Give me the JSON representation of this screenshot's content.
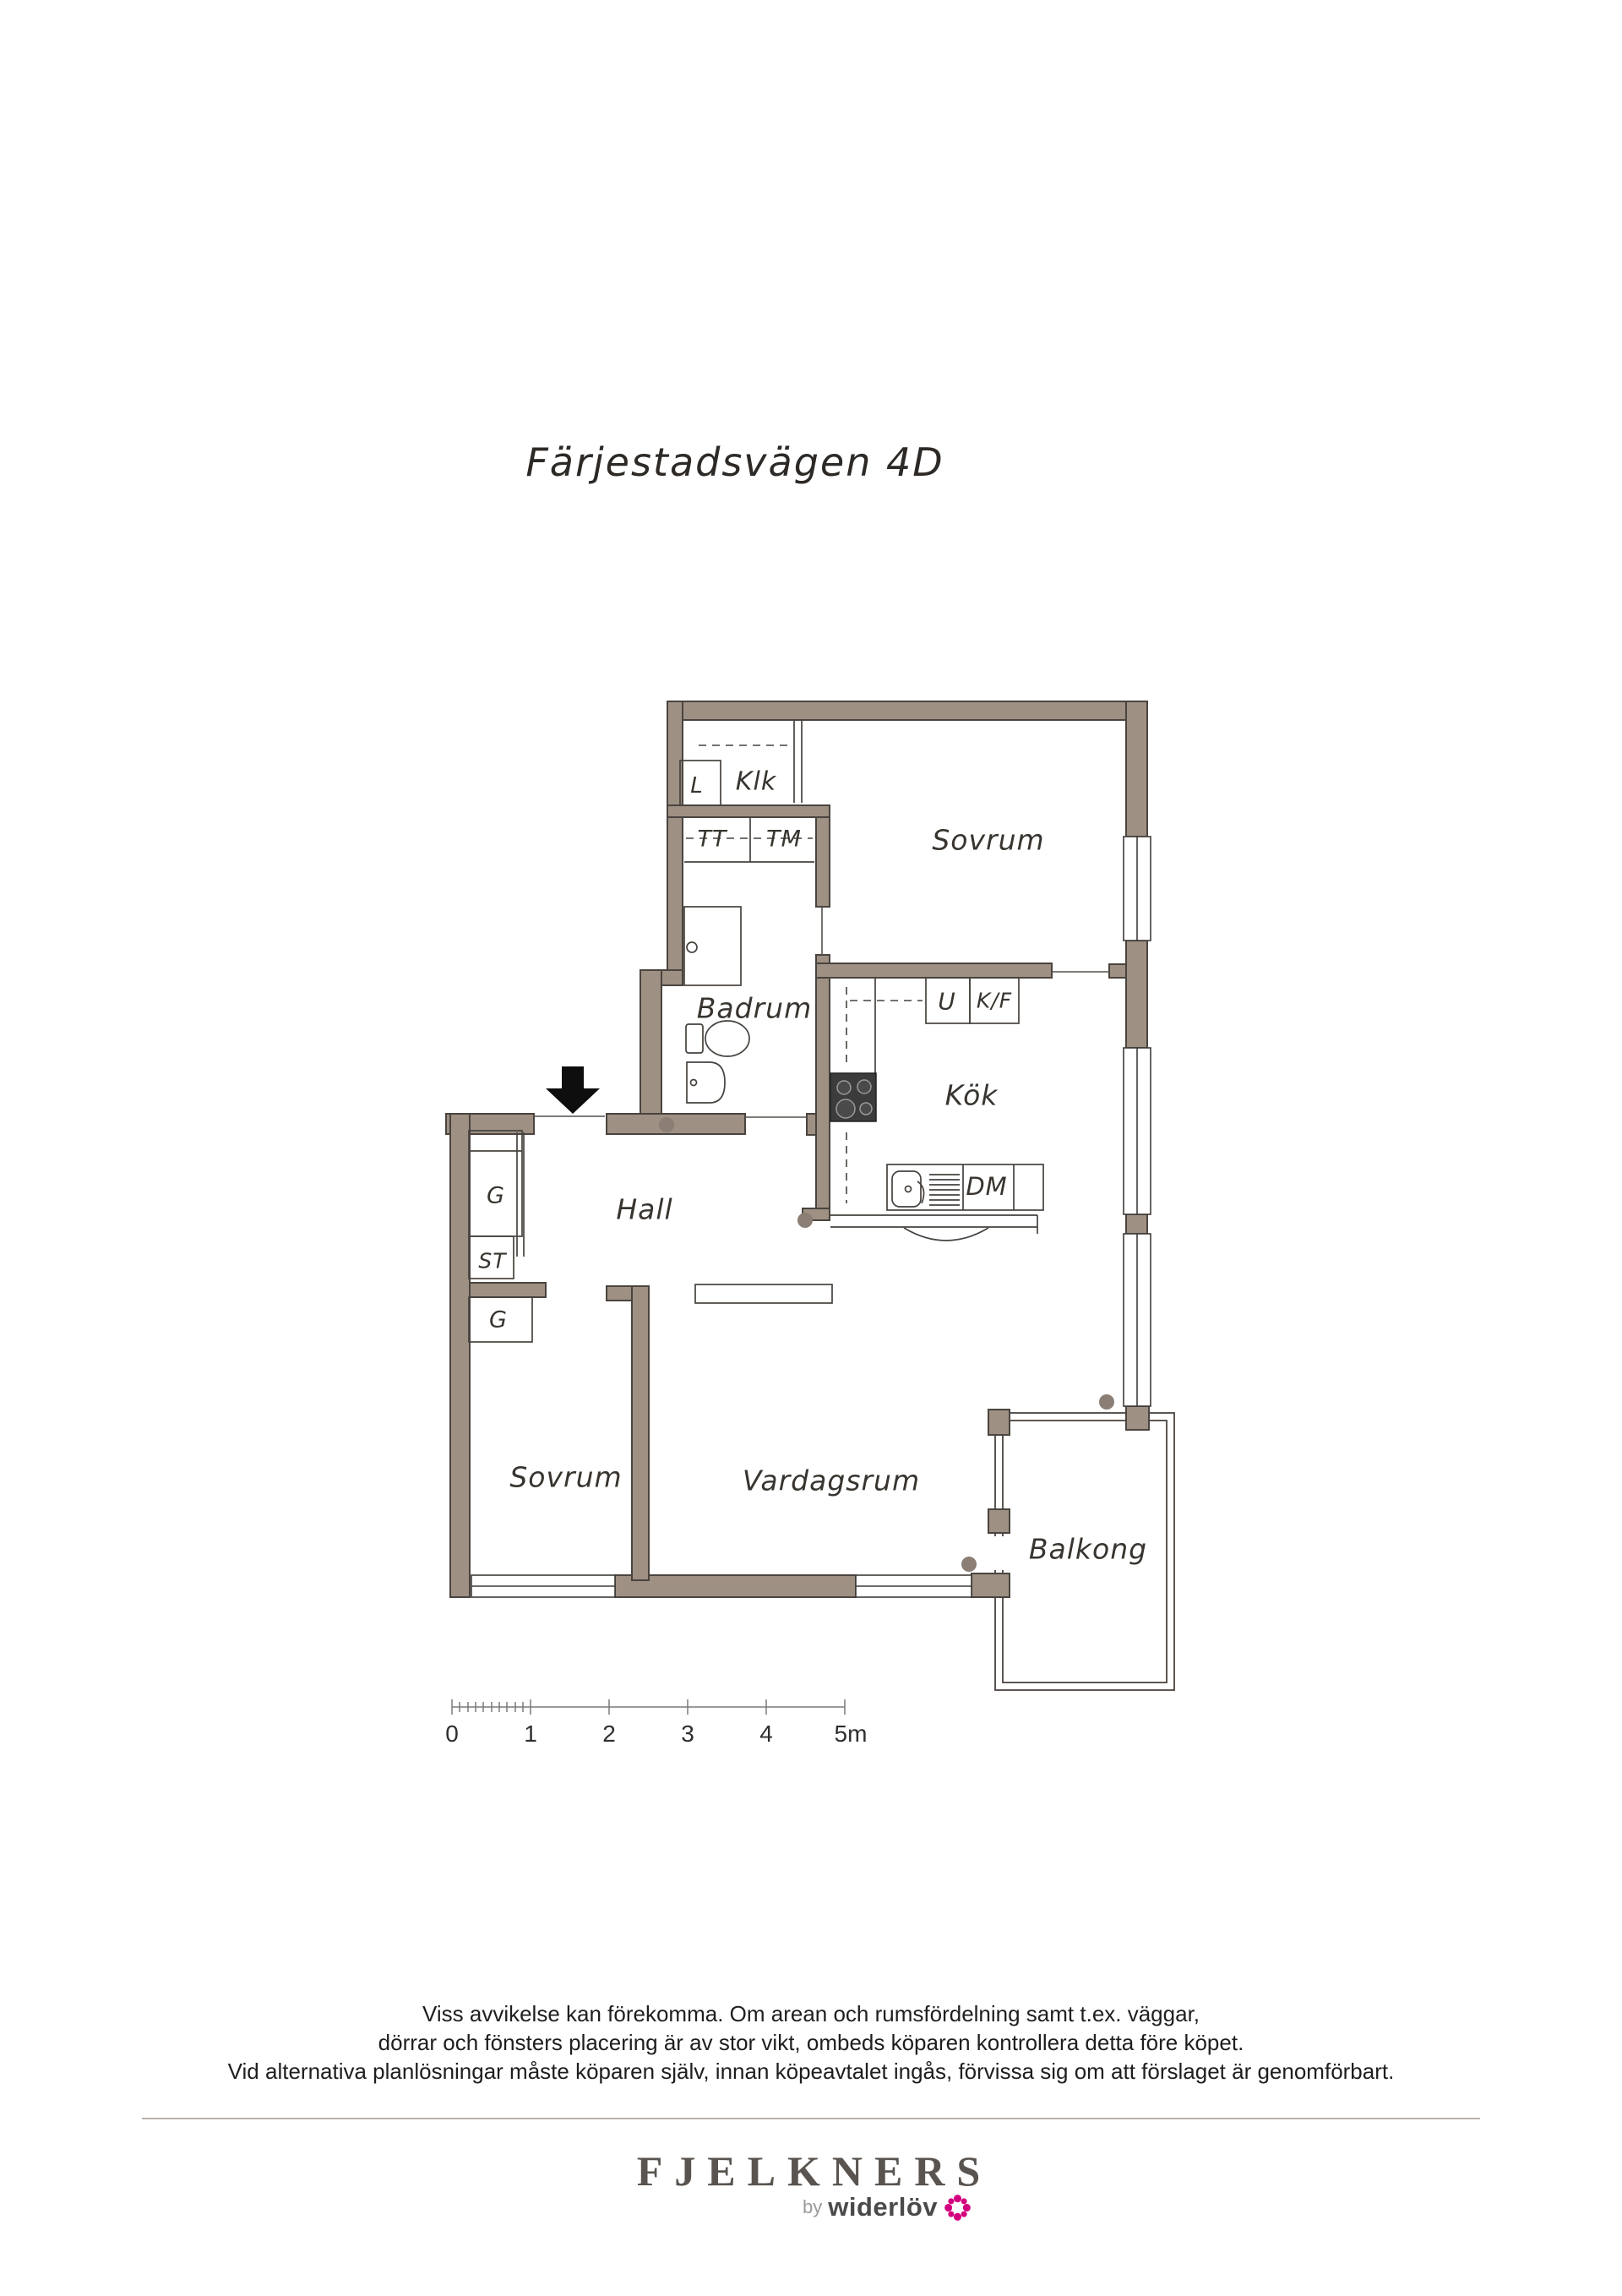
{
  "page": {
    "title": "Färjestadsvägen 4D"
  },
  "floorplan": {
    "wall_color": "#9e9083",
    "dot_color": "#8b7e74",
    "room_labels": {
      "klk": "Klk",
      "linen_l": "L",
      "tt": "TT",
      "tm": "TM",
      "sovrum_top": "Sovrum",
      "u": "U",
      "kf": "K/F",
      "badrum": "Badrum",
      "kok": "Kök",
      "dm": "DM",
      "hall": "Hall",
      "g_top": "G",
      "st": "ST",
      "g_bottom": "G",
      "sovrum_bottom": "Sovrum",
      "vardagsrum": "Vardagsrum",
      "balkong": "Balkong"
    }
  },
  "scale_bar": {
    "ticks": [
      "0",
      "1",
      "2",
      "3",
      "4",
      "5m"
    ]
  },
  "disclaimer": {
    "line1": "Viss avvikelse kan förekomma. Om arean och rumsfördelning samt t.ex. väggar,",
    "line2": "dörrar och fönsters placering är av stor vikt, ombeds köparen kontrollera detta före köpet.",
    "line3": "Vid alternativa planlösningar måste köparen själv, innan köpeavtalet ingås, förvissa sig om att förslaget är genomförbart."
  },
  "footer": {
    "brand": "FJELKNERS",
    "by_prefix": "by",
    "by_brand": "widerlöv",
    "flower_color": "#d4017e"
  }
}
